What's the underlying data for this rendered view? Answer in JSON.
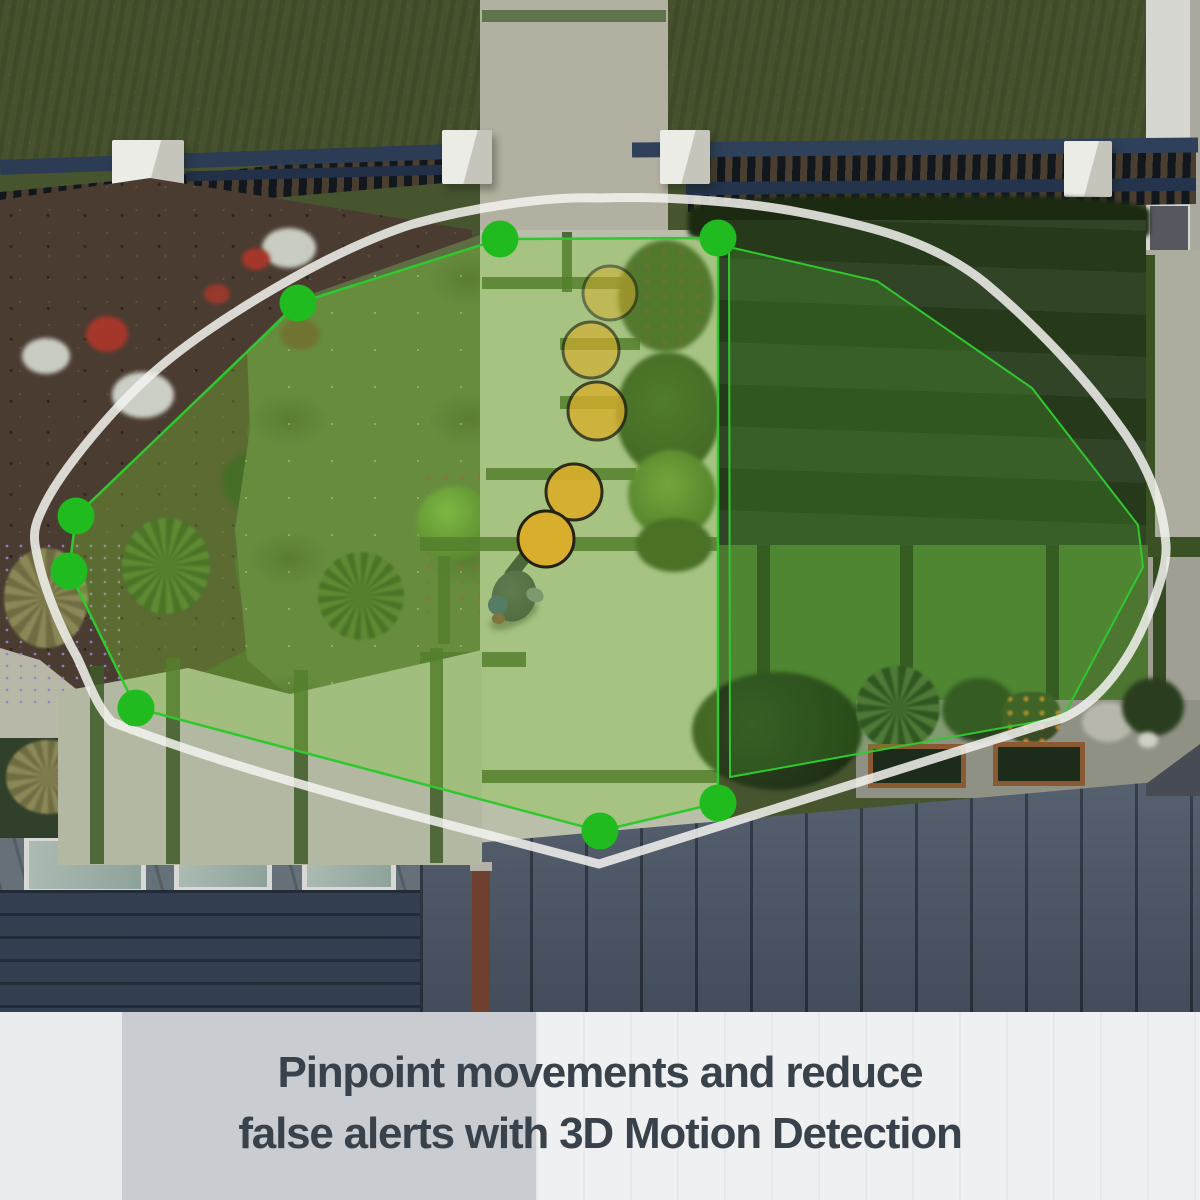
{
  "scene": {
    "description": "Aerial view of a backyard with a security-camera 3D Motion Detection overlay",
    "subject": "person walking on garden path"
  },
  "caption": {
    "line1": "Pinpoint movements and reduce",
    "line2": "false alerts with 3D Motion Detection"
  },
  "overlay": {
    "fov_outline": {
      "stroke": "#f3f3f0",
      "opacity": 0.85,
      "width": 9,
      "path": "M 600,198 C 545,196 470,208 413,224 C 330,250 215,320 161,366 C 118,402 60,470 42,510 C 34,526 33,536 36,550 C 42,582 58,624 77,657 C 88,680 96,706 112,722 C 240,772 430,820 500,838 L 599,864 L 1063,718 C 1100,702 1130,660 1148,615 C 1162,582 1167,560 1166,545 C 1163,500 1145,460 1118,424 C 1085,378 1038,327 984,282 C 935,243 878,227 798,212 C 735,200 652,196 600,198 Z"
    },
    "dot_color": "#1fbb1f",
    "dot_radius": 18.5,
    "zones": [
      {
        "name": "motion-zone-left",
        "points": "500,239 718,238 718,803 600,831 136,708 69,571 76,516 298,303",
        "fill": "rgba(126,204,56,0.33)",
        "stroke": "#2fc82f",
        "stroke_width": 2.5,
        "vertex_dots": [
          [
            500,
            239
          ],
          [
            718,
            238
          ],
          [
            298,
            303
          ],
          [
            76,
            516
          ],
          [
            69,
            571
          ],
          [
            136,
            708
          ],
          [
            600,
            831
          ],
          [
            718,
            803
          ]
        ]
      },
      {
        "name": "motion-zone-right",
        "points": "729,247 877,281 1032,388 1138,525 1143,567 1063,717 730,777",
        "fill": "rgba(86,190,48,0.22)",
        "stroke": "#2fc82f",
        "stroke_width": 2,
        "vertex_dots": []
      }
    ],
    "motion_trail": {
      "fill": "#d9ae2c",
      "stroke": "#23200f",
      "stroke_width": 3,
      "dots": [
        {
          "x": 610,
          "y": 293,
          "r": 27,
          "opacity": 0.5
        },
        {
          "x": 591,
          "y": 350,
          "r": 28,
          "opacity": 0.64
        },
        {
          "x": 597,
          "y": 411,
          "r": 29,
          "opacity": 0.78
        },
        {
          "x": 574,
          "y": 492,
          "r": 28,
          "opacity": 0.92
        },
        {
          "x": 546,
          "y": 539,
          "r": 28,
          "opacity": 1
        }
      ]
    }
  }
}
